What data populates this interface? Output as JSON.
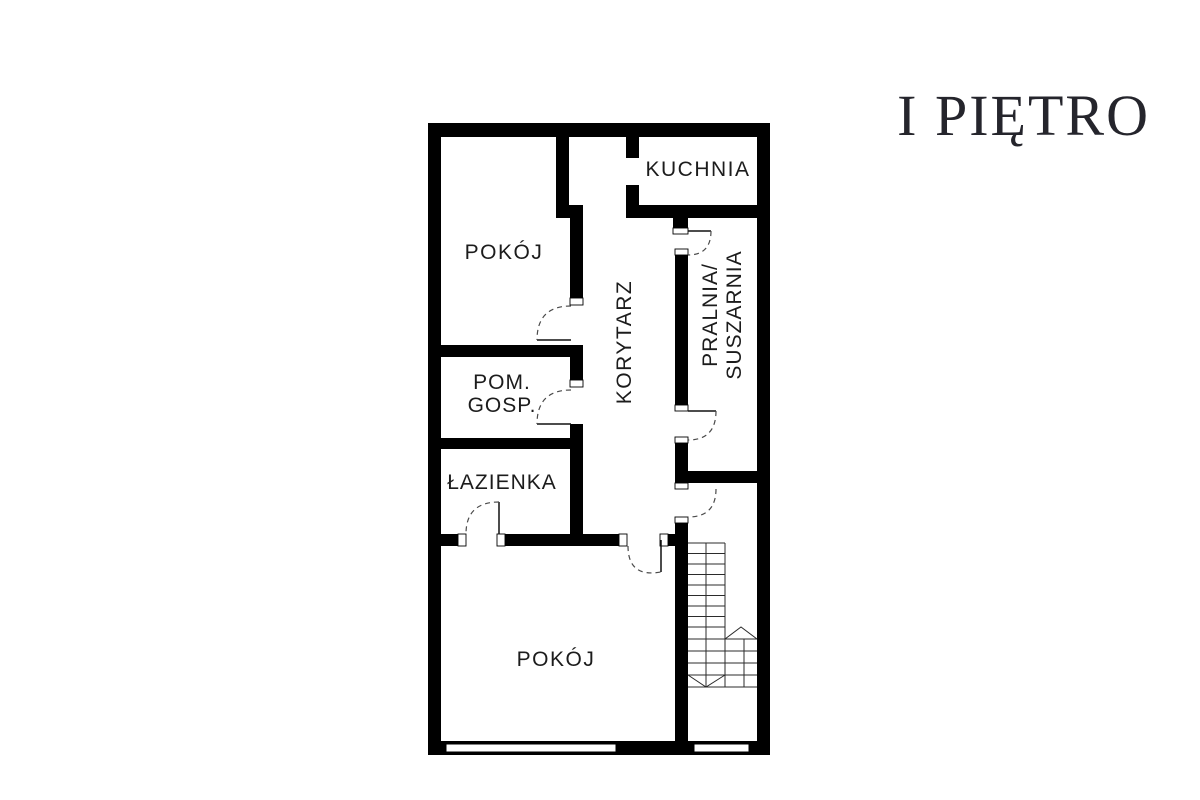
{
  "title": "I PIĘTRO",
  "colors": {
    "wall": "#000000",
    "label": "#1c1c1c",
    "title_color": "#25252c",
    "door_arc": "#4a4a4a",
    "door_leaf": "#111111",
    "stairs": "#2b2b2b",
    "jamb_outline": "#000000",
    "background": "#ffffff"
  },
  "rooms": {
    "kuchnia": {
      "label": "KUCHNIA"
    },
    "pokoj_top": {
      "label": "POKÓJ"
    },
    "korytarz": {
      "label": "KORYTARZ"
    },
    "pralnia": {
      "label_line1": "PRALNIA/",
      "label_line2": "SUSZARNIA"
    },
    "pom_gosp": {
      "label_line1": "POM.",
      "label_line2": "GOSP."
    },
    "lazienka": {
      "label": "ŁAZIENKA"
    },
    "pokoj_bottom": {
      "label": "POKÓJ"
    }
  }
}
